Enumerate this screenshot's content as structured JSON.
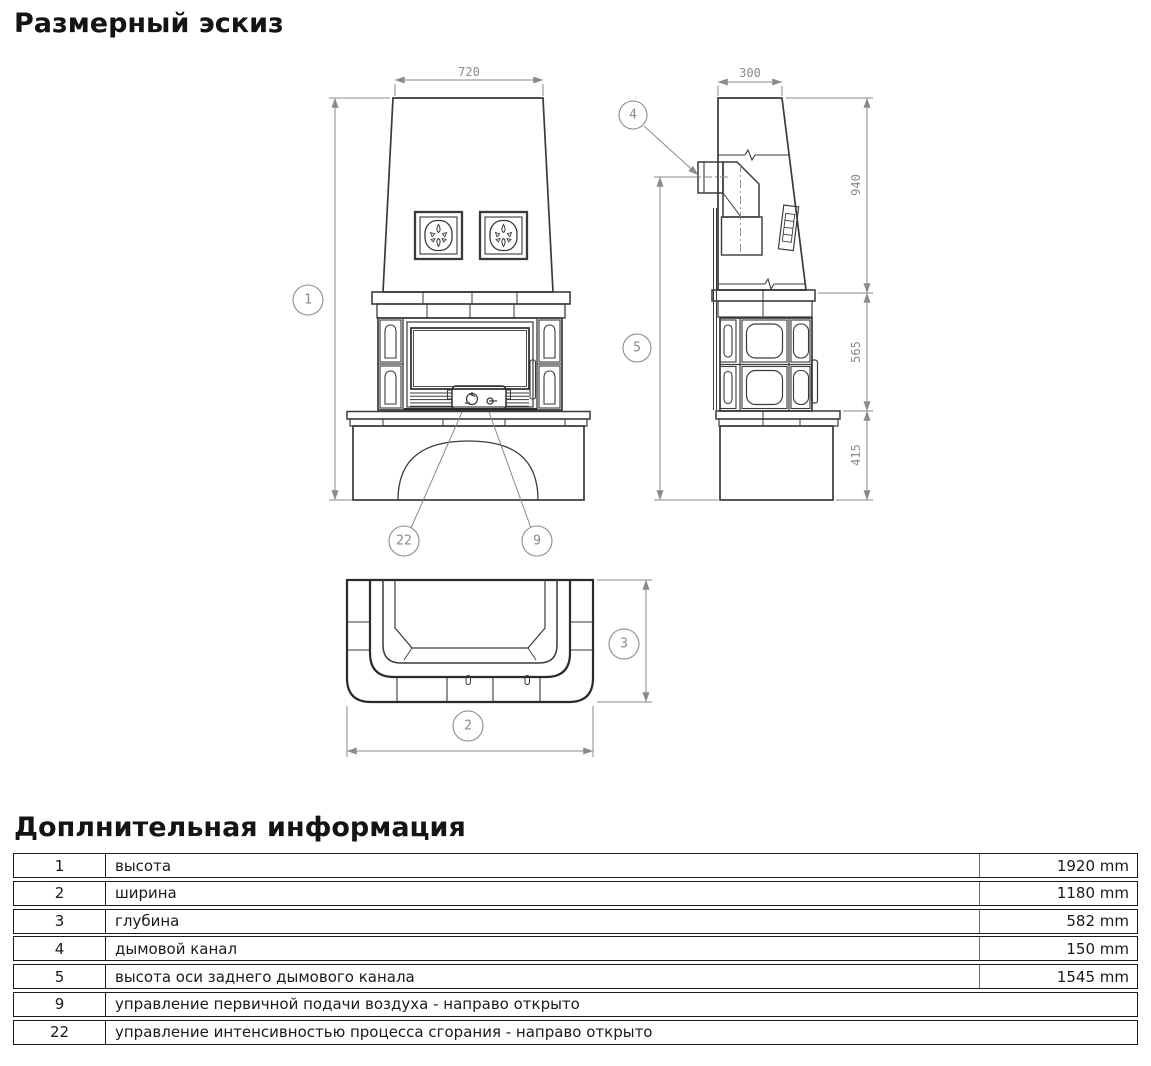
{
  "page": {
    "title": "Размерный эскиз",
    "table_title": "Доплнительная информация"
  },
  "drawing": {
    "dims": {
      "front_width": "720",
      "side_depth_top": "300",
      "side_upper": "940",
      "side_middle": "565",
      "side_lower": "415"
    },
    "callouts": {
      "c1": "1",
      "c2": "2",
      "c3": "3",
      "c4": "4",
      "c5": "5",
      "c9": "9",
      "c22": "22"
    },
    "line_color": "#3a3a3a",
    "dim_color": "#8a8a8a"
  },
  "table": {
    "rows": [
      {
        "num": "1",
        "label": "высота",
        "value": "1920 mm"
      },
      {
        "num": "2",
        "label": "ширина",
        "value": "1180 mm"
      },
      {
        "num": "3",
        "label": "глубина",
        "value": "582 mm"
      },
      {
        "num": "4",
        "label": "дымовой канал",
        "value": "150 mm"
      },
      {
        "num": "5",
        "label": "высота оси заднего дымового канала",
        "value": "1545 mm"
      },
      {
        "num": "9",
        "label": "управление первичной подачи воздуха - направо открыто",
        "value": ""
      },
      {
        "num": "22",
        "label": "управление интенсивностью процесса сгорания - направо открыто",
        "value": ""
      }
    ]
  }
}
